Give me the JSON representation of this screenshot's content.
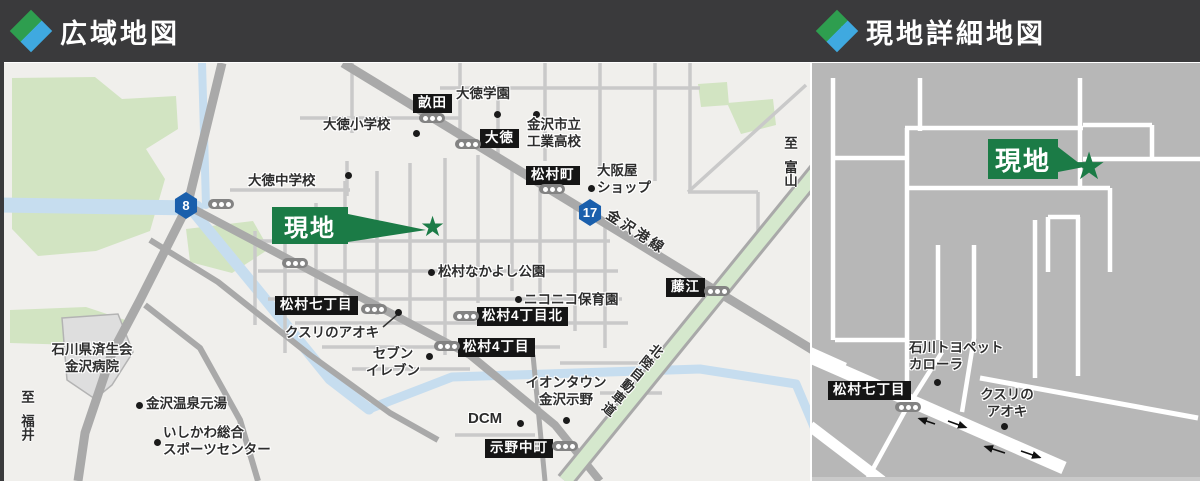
{
  "header": {
    "wide_title": "広域地図",
    "detail_title": "現地詳細地図"
  },
  "icons": {
    "star": "★"
  },
  "wide_map": {
    "site_label": "現地",
    "route_numbers": [
      "8",
      "17"
    ],
    "road_names": {
      "kanazawa_port_line": "金沢港線",
      "hokuriku_expressway": "北陸自動車道"
    },
    "area_badges": [
      "畝田",
      "大徳",
      "松村町",
      "藤江",
      "松村七丁目",
      "松村4丁目北",
      "松村4丁目",
      "示野中町"
    ],
    "pois": {
      "daitoku_gakuen": "大徳学園",
      "kanazawa_tech_line1": "金沢市立",
      "kanazawa_tech_line2": "工業高校",
      "daitoku_elementary": "大徳小学校",
      "daitoku_junior_high": "大徳中学校",
      "osakaya_line1": "大阪屋",
      "osakaya_line2": "ショップ",
      "nakayoshi_park": "松村なかよし公園",
      "nikoniko_nursery": "ニコニコ保育園",
      "kusuri_no_aoki": "クスリのアオキ",
      "seven_line1": "セブン",
      "seven_line2": "イレブン",
      "aeon_line1": "イオンタウン",
      "aeon_line2": "金沢示野",
      "dcm": "DCM",
      "hospital_line1": "石川県済生会",
      "hospital_line2": "金沢病院",
      "onsen": "金沢温泉元湯",
      "sports_line1": "いしかわ総合",
      "sports_line2": "スポーツセンター"
    },
    "direction_toyama": {
      "prefix": "至",
      "place": "富山"
    },
    "direction_fukui": {
      "prefix": "至",
      "place": "福井"
    }
  },
  "detail_map": {
    "site_label": "現地",
    "area_badge": "松村七丁目",
    "pois": {
      "toyopet_line1": "石川トヨペット",
      "toyopet_line2": "カローラ",
      "aoki_line1": "クスリの",
      "aoki_line2": "アオキ"
    }
  },
  "colors": {
    "accent_green": "#1B7B46",
    "diamond_green": "#2E9E4F",
    "diamond_blue": "#3FA9E0",
    "route_blue": "#1A5FAC"
  }
}
